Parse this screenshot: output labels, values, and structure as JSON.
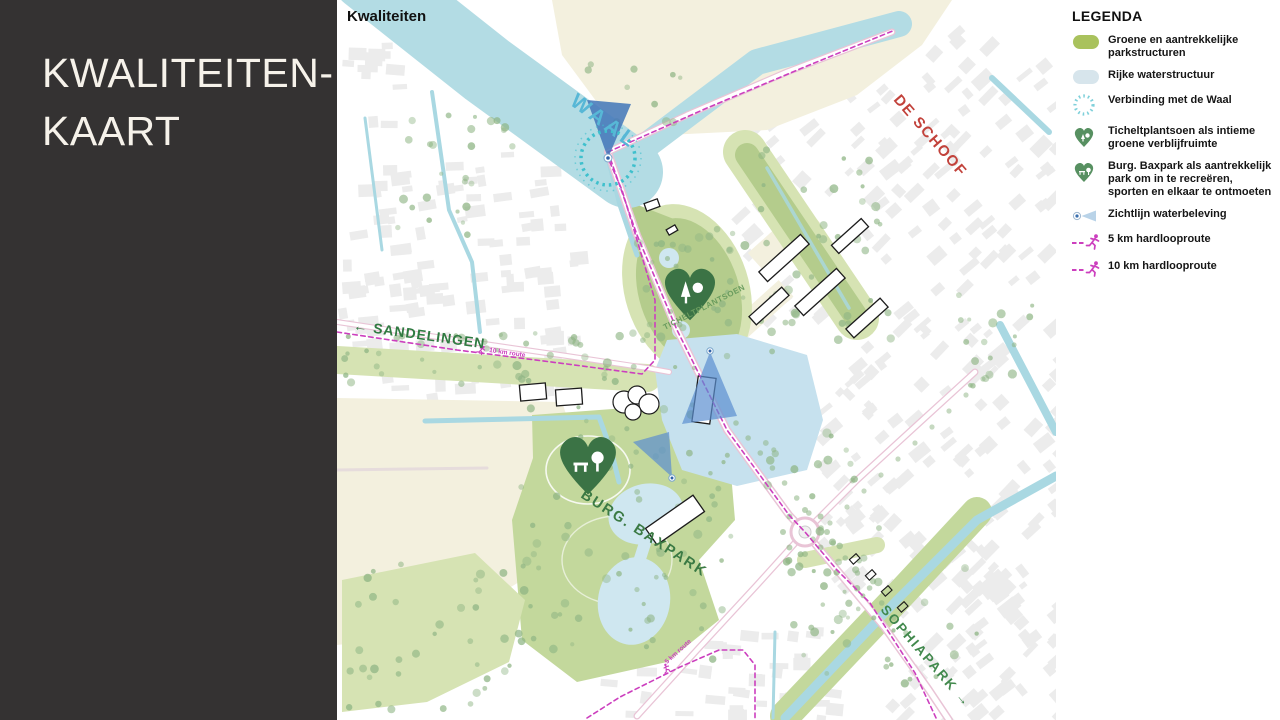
{
  "slide": {
    "title": "KWALITEITEN-\nKAART"
  },
  "map": {
    "title": "Kwaliteiten",
    "labels": {
      "waal": "WAAL",
      "deschoof": "DE SCHOOF",
      "sandelingen": "← SANDELINGEN",
      "tichelt": "TICHELTPLANTSOEN",
      "baxpark": "BURG. BAXPARK",
      "sophiapark": "SOPHIAPARK →",
      "route10": "10 km route",
      "route5": "5 km route"
    }
  },
  "legend": {
    "title": "LEGENDA",
    "items": [
      {
        "icon": "park-area-icon",
        "label": "Groene en aantrekkelijke parkstructuren"
      },
      {
        "icon": "water-area-icon",
        "label": "Rijke waterstructuur"
      },
      {
        "icon": "waal-connection-icon",
        "label": "Verbinding met de Waal"
      },
      {
        "icon": "ticheltplantsoen-heart-icon",
        "label": "Ticheltplantsoen als intieme groene verblijfruimte"
      },
      {
        "icon": "baxpark-heart-icon",
        "label": "Burg. Baxpark als aantrekkelijk park om in te recreëren, sporten en elkaar te ontmoeten"
      },
      {
        "icon": "sightline-icon",
        "label": "Zichtlijn waterbeleving"
      },
      {
        "icon": "run-route-5km-icon",
        "label": "5 km hardlooproute"
      },
      {
        "icon": "run-route-10km-icon",
        "label": "10 km hardlooproute"
      }
    ]
  },
  "colors": {
    "panel": "#343232",
    "panel_text": "#f6f2ea",
    "water": "#b3dce4",
    "water_light": "#c6e1ee",
    "pond": "#cfe7f0",
    "canal": "#a9d8e2",
    "cream": "#f3f0de",
    "park_light": "#d6e3b3",
    "park": "#c3d89c",
    "park_med": "#b4cc8c",
    "tree": "#8db483",
    "building": "#ececec",
    "building_outline": "#1c1c1c",
    "road_casing": "#e9c4d6",
    "road_faint": "#e6dcdc",
    "route_magenta": "#cc3fbe",
    "teal_dash": "#3fc0cd",
    "cone_blue": "#5b8fd0",
    "cone_dark": "#4679ba",
    "heart_green": "#3b7345",
    "legend_heart": "#579061",
    "label_green": "#2f7a41",
    "label_green_light": "#6a9c5e",
    "label_blue": "#57b7d6",
    "label_red": "#c2423b"
  }
}
